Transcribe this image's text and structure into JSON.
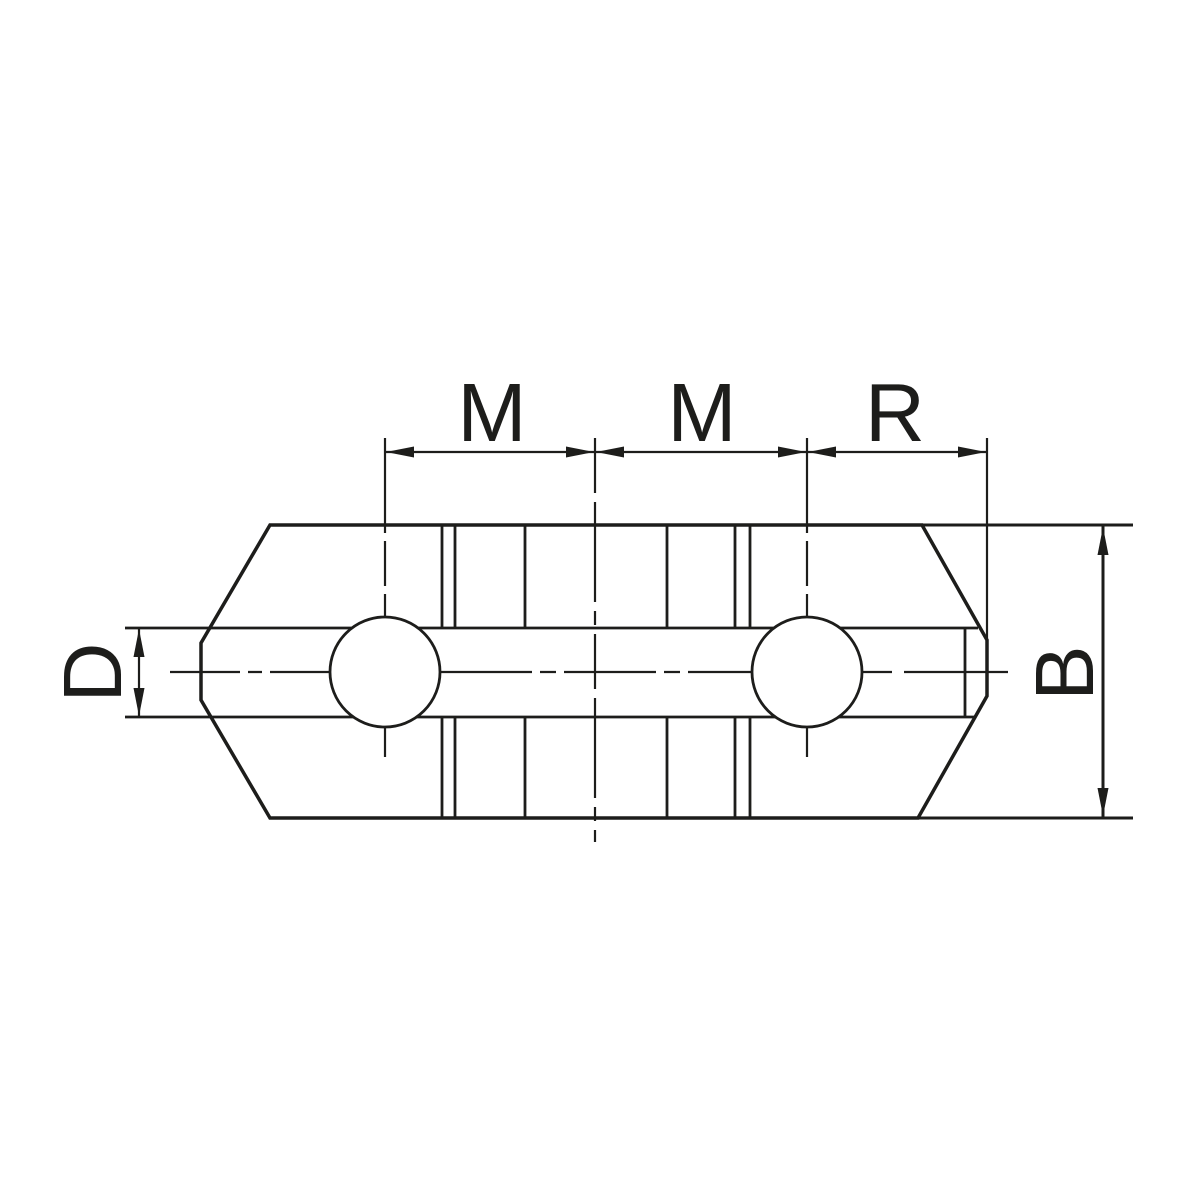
{
  "drawing": {
    "type": "technical-dimension-drawing",
    "colors": {
      "ink": "#1d1d1b",
      "background": "#ffffff"
    },
    "dimensions": {
      "m1": "M",
      "m2": "M",
      "r": "R",
      "d": "D",
      "b": "B"
    }
  }
}
